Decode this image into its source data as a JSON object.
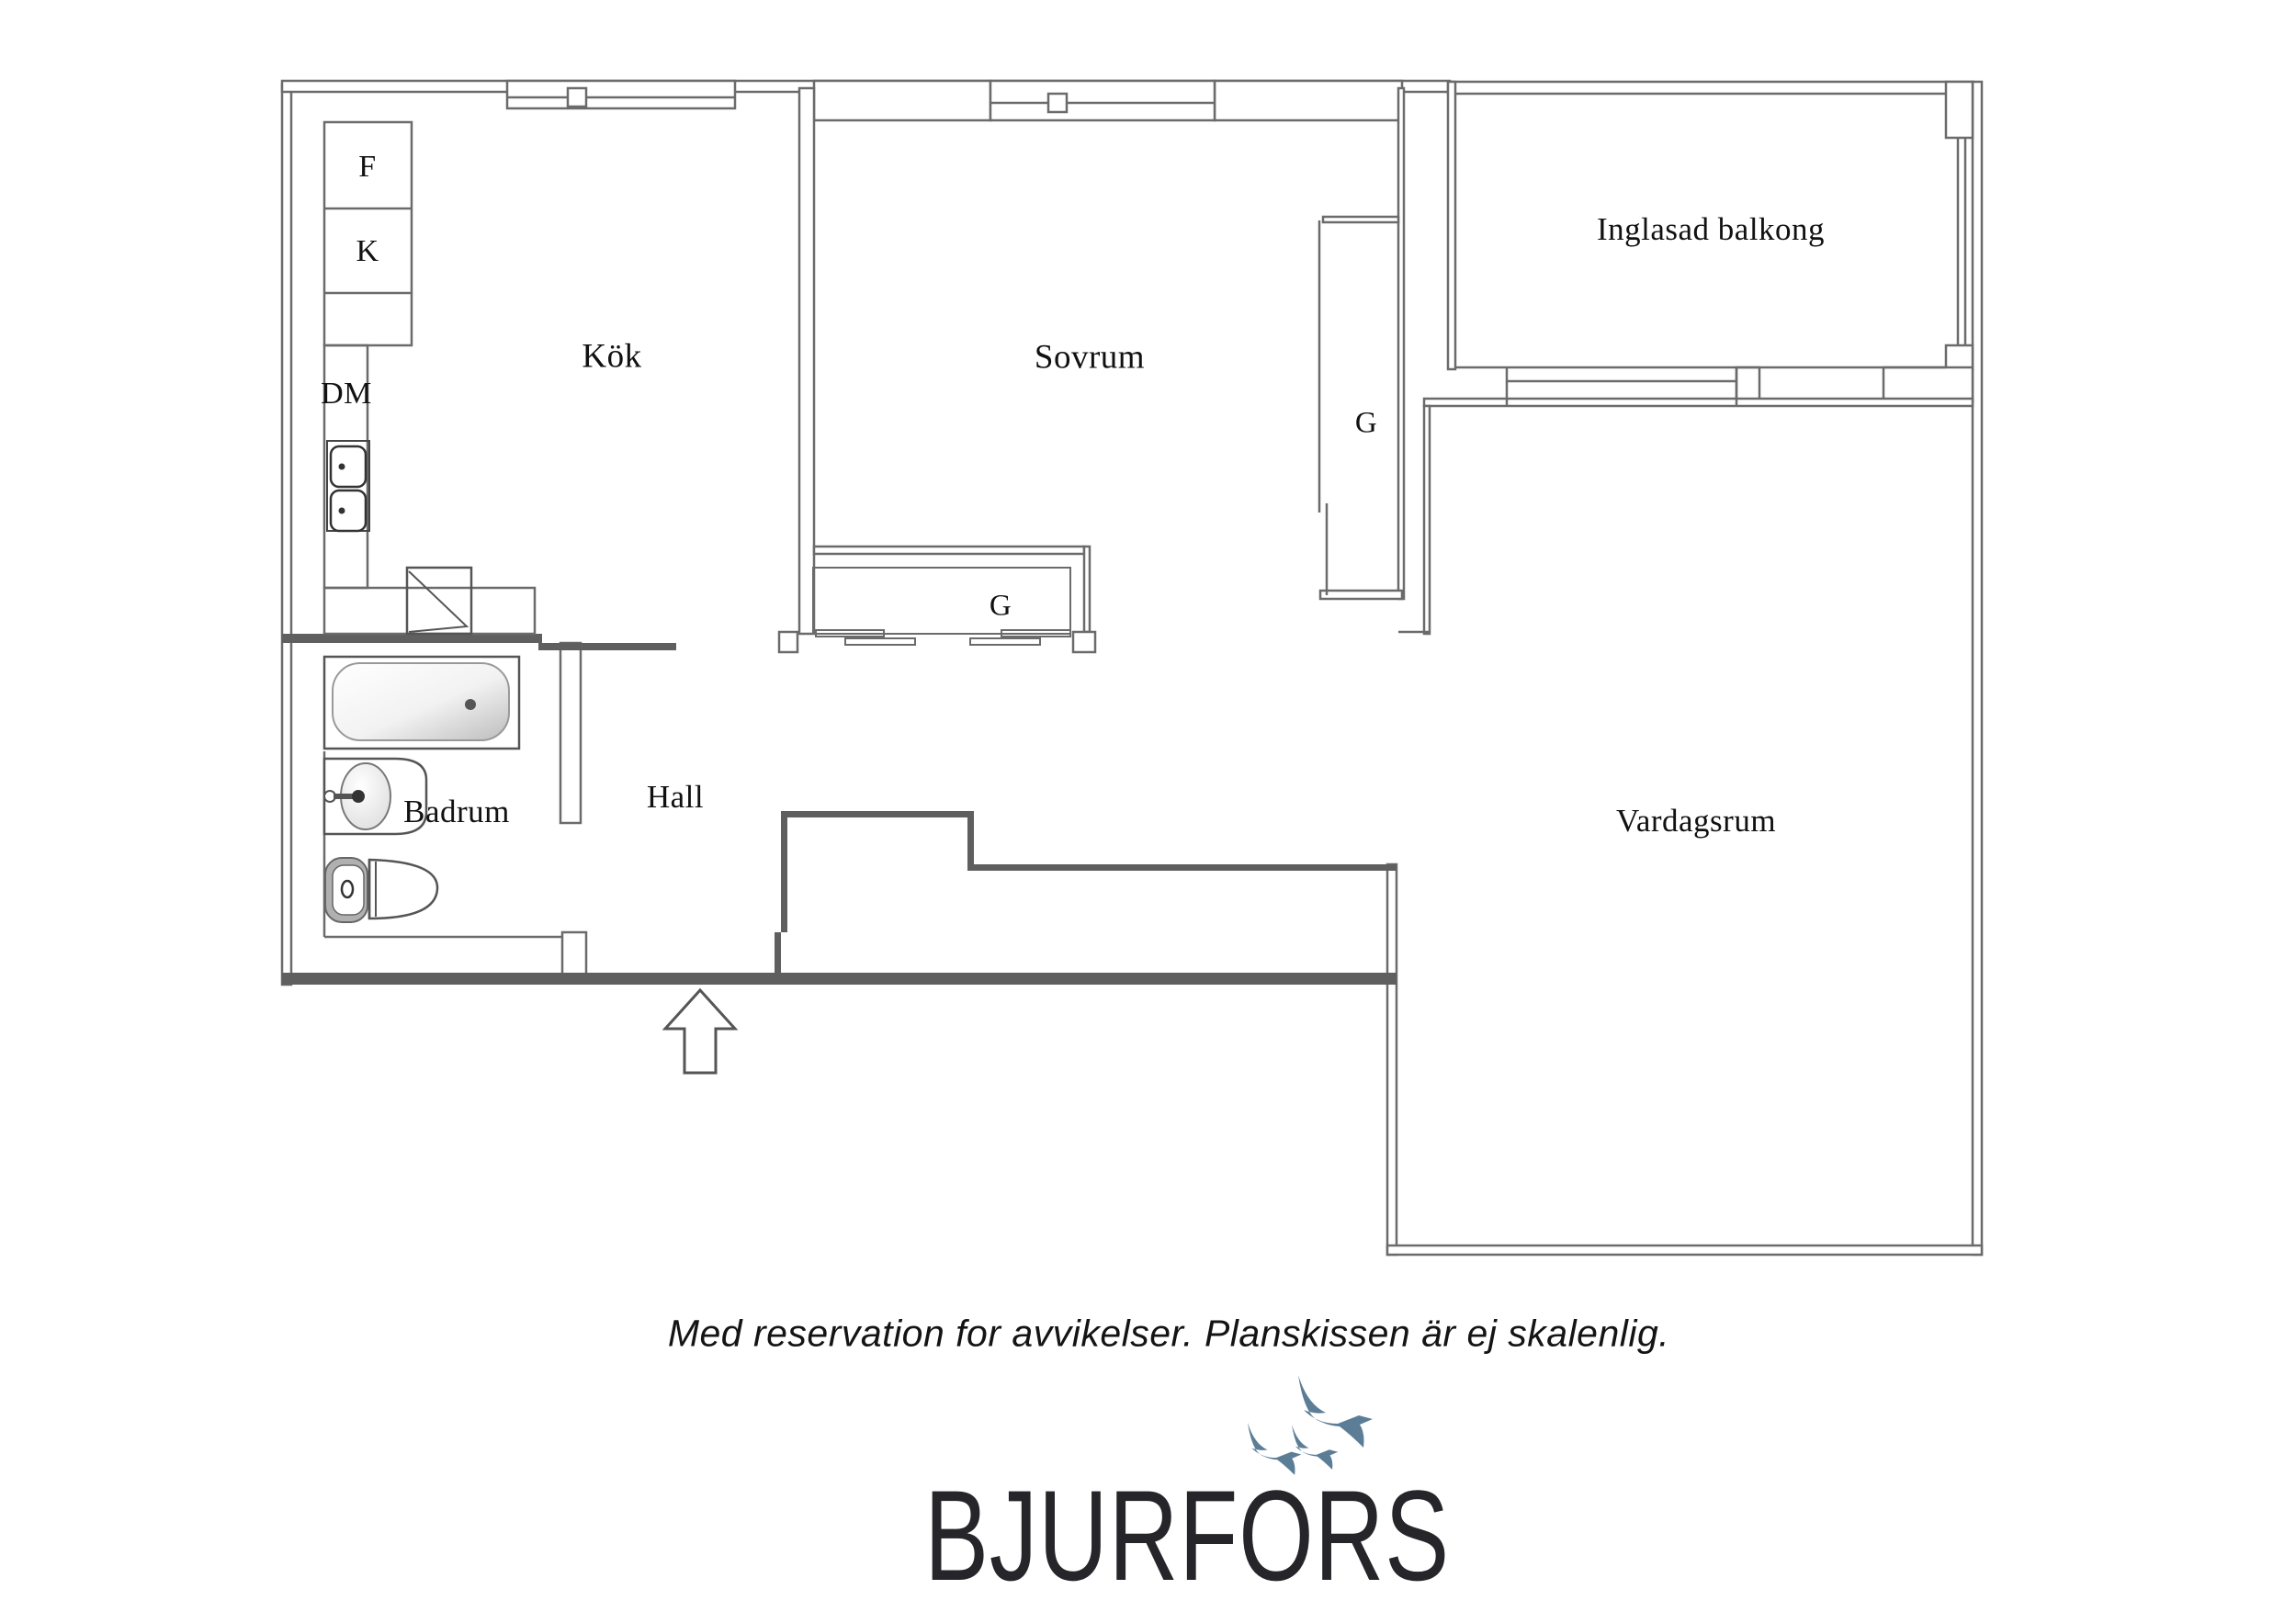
{
  "floorplan": {
    "labels": {
      "f": "F",
      "k": "K",
      "dm": "DM",
      "kok": "Kök",
      "sovrum": "Sovrum",
      "g_wardrobe": "G",
      "g_closet": "G",
      "balcony": "Inglasad balkong",
      "hall": "Hall",
      "badrum": "Badrum",
      "vardagsrum": "Vardagsrum"
    },
    "disclaimer": "Med reservation for avvikelser. Planskissen är ej skalenlig.",
    "brand": "BJURFORS",
    "colors": {
      "bird_blue": "#5c7d96",
      "logo_text": "#26262a",
      "wall_line": "#6b6b6b",
      "wall_solid": "#5f5f5f",
      "label_text": "#111111"
    }
  }
}
